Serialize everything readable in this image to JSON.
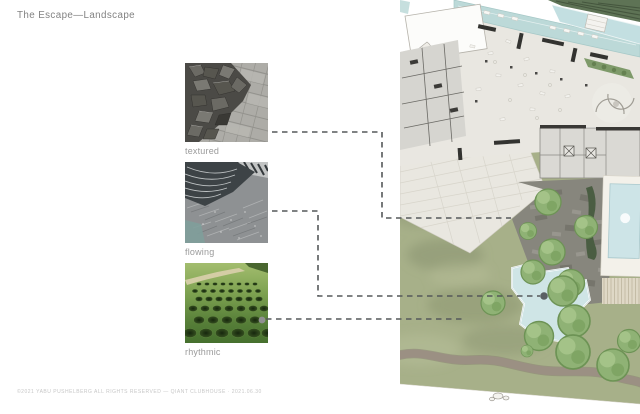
{
  "slide": {
    "title": "The Escape—Landscape",
    "footer": "©2021 YABU PUSHELBERG ALL RIGHTS RESERVED — QIANT CLUBHOUSE · 2021.06.30"
  },
  "concepts": [
    {
      "label": "textured",
      "image": "broken-granite-paving-photo"
    },
    {
      "label": "flowing",
      "image": "water-over-stone-weir-photo"
    },
    {
      "label": "rhythmic",
      "image": "grass-landform-craters-photo"
    }
  ],
  "site_plan": {
    "description": "clubhouse landscape masterplan with lawn, terraces, pools and trees"
  },
  "colors": {
    "lawn_green": "#a7b089",
    "water_blue": "#cde4e7",
    "pool_teal": "#bcd9d8",
    "paving_light": "#e9e7e0",
    "paving_dark": "#87867d",
    "dash_gray": "#55585a",
    "label_gray": "#9a9a9a",
    "title_gray": "#828282",
    "footer_gray": "#c7c7c7"
  }
}
